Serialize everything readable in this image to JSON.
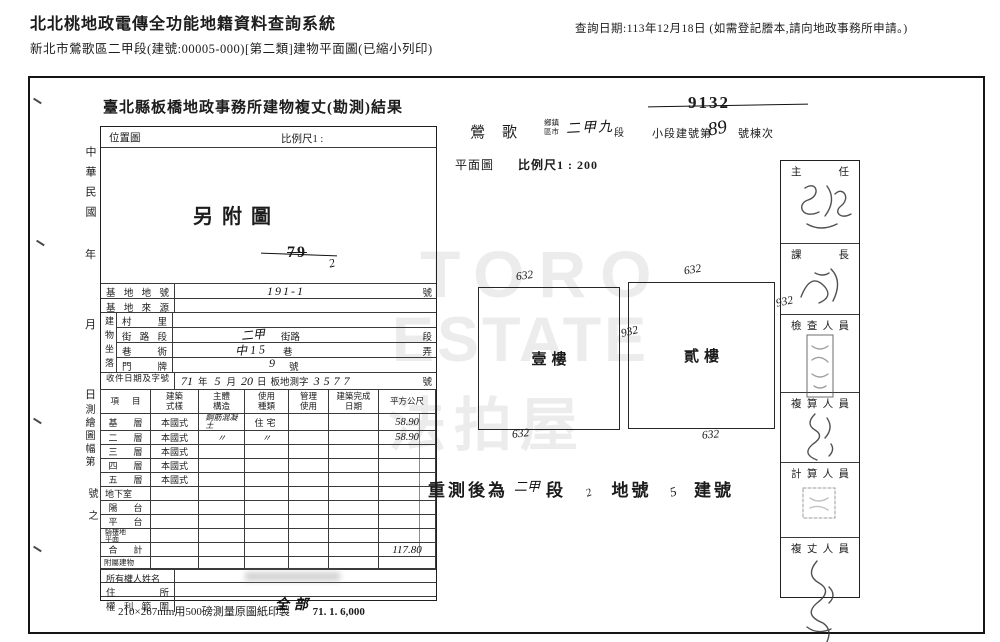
{
  "header": {
    "title": "北北桃地政電傳全功能地籍資料查詢系統",
    "subtitle": "新北市鶯歌區二甲段(建號:00005-000)[第二類]建物平面圖(已縮小列印)",
    "query_note": "查詢日期:113年12月18日 (如需登記謄本,請向地政事務所申請。)"
  },
  "doc": {
    "title": "臺北縣板橋地政事務所建物複丈(勘測)結果",
    "margin": {
      "era": "中華民國",
      "year": "年",
      "month": "月",
      "day": "日",
      "sheet": "測繪圖幅第",
      "sheet_no": "號之"
    },
    "location": {
      "label": "位置圖",
      "scale": "比例尺1 :",
      "stamp": "另附圖",
      "struck": "79",
      "mark": "2"
    },
    "site": {
      "lot": {
        "label": "基地地號",
        "value": "191-1",
        "unit": "號"
      },
      "source": {
        "label": "基地來源"
      },
      "situs": {
        "group": "建物坐落",
        "village": "村里",
        "street": {
          "label": "街路段",
          "value": "二甲",
          "mid": "街路",
          "unit": "段"
        },
        "lane": {
          "label": "巷衖",
          "value": "中15",
          "mid": "巷",
          "unit": "弄"
        },
        "door": {
          "label": "門牌",
          "value": "9",
          "unit": "號"
        }
      },
      "receipt": {
        "label": "收件日期及字號",
        "year": "71",
        "year_u": "年",
        "month": "5",
        "month_u": "月",
        "day": "20",
        "day_u": "日",
        "code": "板地測字",
        "number": "3577",
        "unit": "號"
      }
    },
    "floors": {
      "headers": [
        "項目",
        "建築式樣",
        "主體構造",
        "使用種類",
        "管理使用",
        "建築完成日期",
        "平方公尺"
      ],
      "rows": [
        {
          "label": "基層",
          "style": "本國式",
          "structure": "鋼筋混凝土",
          "use": "住宅",
          "area": "58.90"
        },
        {
          "label": "二層",
          "style": "本國式",
          "structure": "〃",
          "use": "〃",
          "area": "58.90"
        },
        {
          "label": "三層",
          "style": "本國式"
        },
        {
          "label": "四層",
          "style": "本國式"
        },
        {
          "label": "五層",
          "style": "本國式"
        },
        {
          "label": "地下室"
        },
        {
          "label": "陽台"
        },
        {
          "label": "平台"
        },
        {
          "label": "騎樓地平面"
        }
      ],
      "total": {
        "label": "合計",
        "area": "117.80"
      },
      "annex": {
        "label": "附屬建物"
      }
    },
    "owner": {
      "name_label": "所有權人姓名",
      "addr_label": "住所",
      "rights_label": "權利範圍",
      "rights_value": "全部"
    },
    "print_note": "210×267mm用500磅測量原圖紙印製",
    "print_code": "71. 1. 6,000",
    "plan": {
      "struck_no": "9132",
      "town": "鶯歌",
      "town_unit": "鄉鎮區市",
      "section": "二甲九",
      "section_u": "段",
      "bldg_label": "小段建號第",
      "bldg_no": "89",
      "bldg_suffix": "號棟次",
      "view_label": "平面圖",
      "scale": "比例尺1 : 200",
      "rects": [
        {
          "name": "壹樓",
          "top": "632",
          "right": "932",
          "bottom": "632"
        },
        {
          "name": "貳樓",
          "top": "632",
          "right": "932",
          "bottom": "632"
        }
      ],
      "resurvey": {
        "prefix": "重測後為",
        "section": "二甲",
        "section_u": "段",
        "lot_mark": "2",
        "lot_u": "地號",
        "bldg_mark": "5",
        "bldg_u": "建號"
      }
    },
    "signoff": [
      "主任",
      "課長",
      "檢查人員",
      "複算人員",
      "計算人員",
      "複丈人員"
    ],
    "watermark": [
      "TORO",
      "ESTATE",
      "法拍屋"
    ]
  }
}
